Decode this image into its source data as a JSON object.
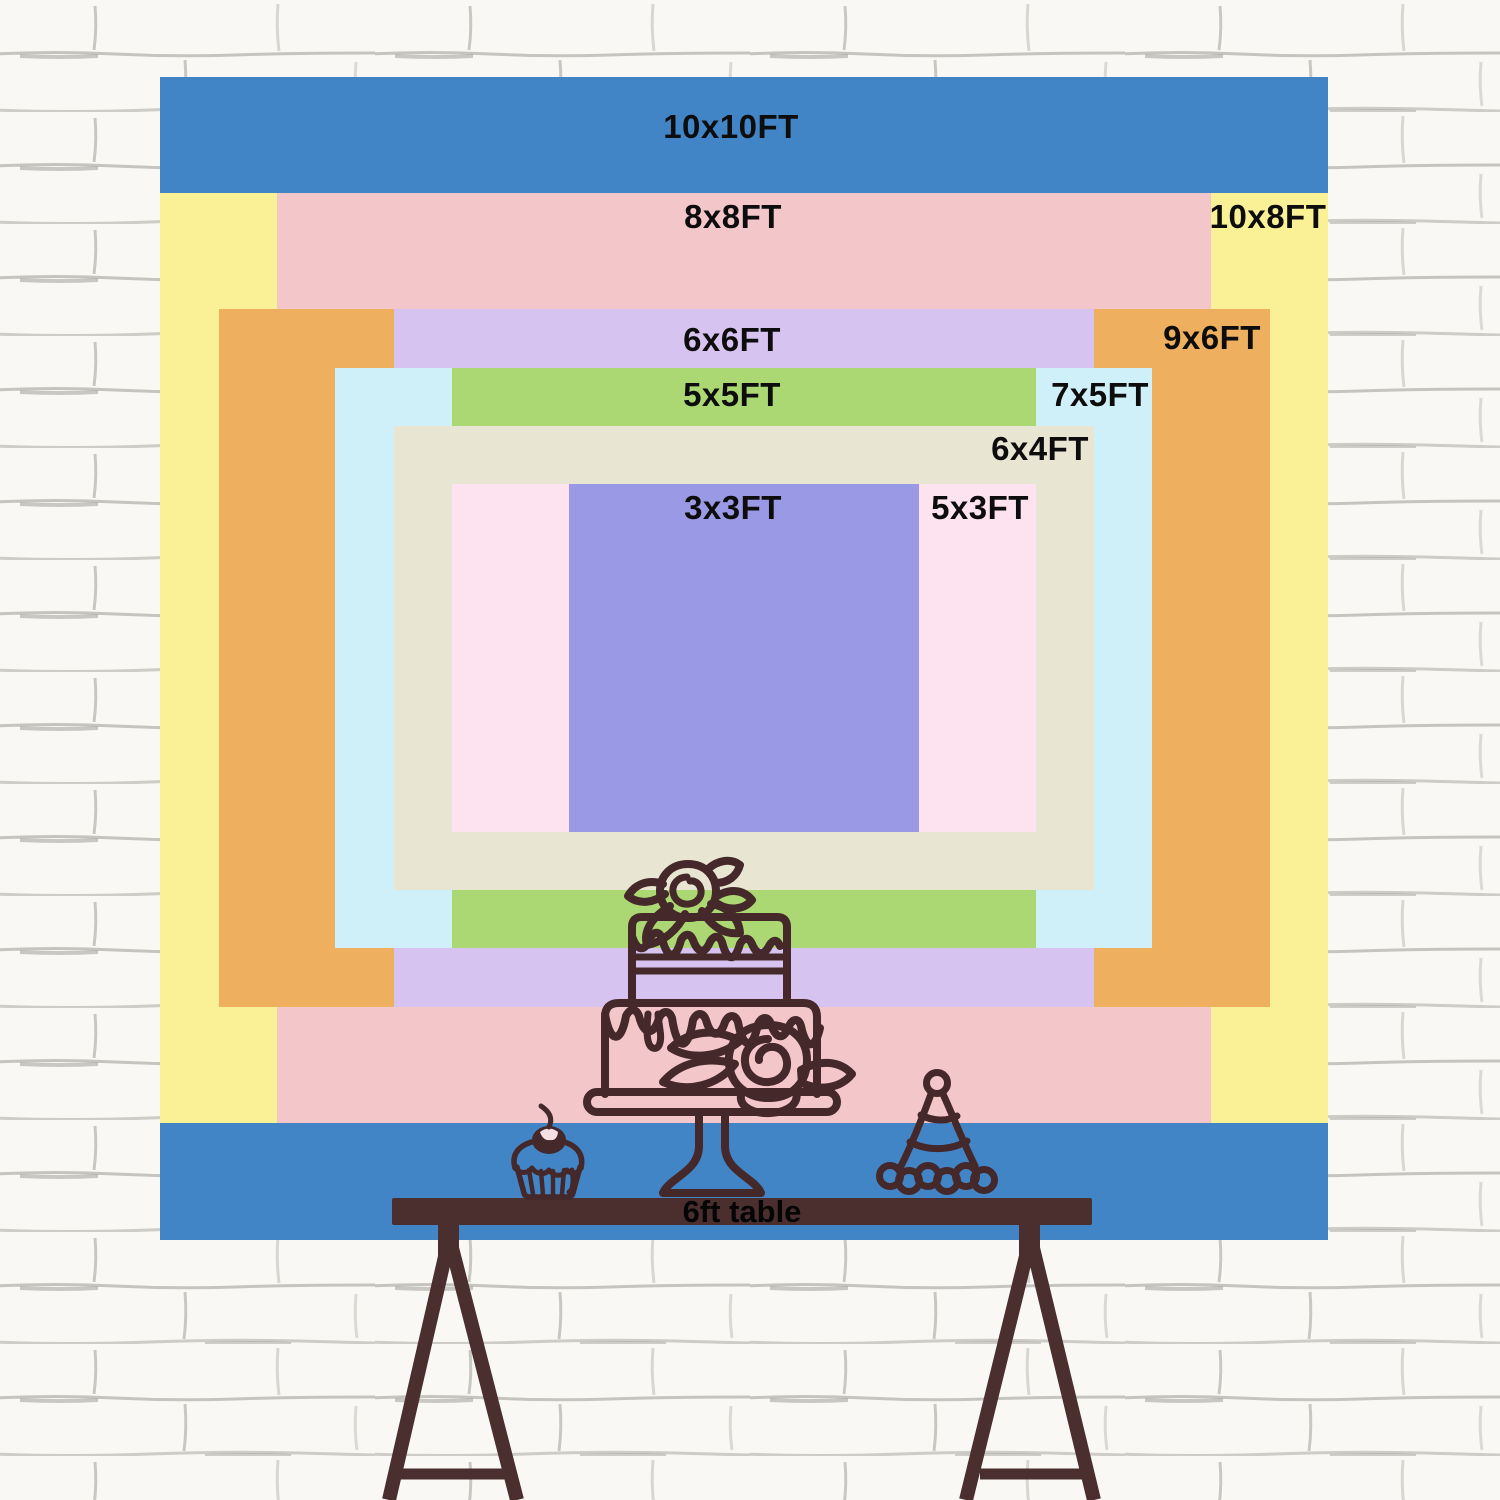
{
  "backdrop": {
    "unit": "FT",
    "label_color": "#0D0D0D",
    "sizes": [
      {
        "label": "10x10FT",
        "width_ft": 10,
        "height_ft": 10,
        "color": "#4285C7",
        "rect": {
          "x": 160,
          "y": 77,
          "w": 1168,
          "h": 1163
        },
        "label_pos": {
          "x": 731,
          "y": 127
        }
      },
      {
        "label": "10x8FT",
        "width_ft": 10,
        "height_ft": 8,
        "color": "#FAF096",
        "rect": {
          "x": 160,
          "y": 193,
          "w": 1168,
          "h": 930
        },
        "label_pos": {
          "x": 1268,
          "y": 217
        }
      },
      {
        "label": "8x8FT",
        "width_ft": 8,
        "height_ft": 8,
        "color": "#F3C6CA",
        "rect": {
          "x": 277,
          "y": 193,
          "w": 934,
          "h": 930
        },
        "label_pos": {
          "x": 733,
          "y": 217
        }
      },
      {
        "label": "9x6FT",
        "width_ft": 9,
        "height_ft": 6,
        "color": "#EEB05F",
        "rect": {
          "x": 219,
          "y": 309,
          "w": 1051,
          "h": 698
        },
        "label_pos": {
          "x": 1212,
          "y": 338
        }
      },
      {
        "label": "6x6FT",
        "width_ft": 6,
        "height_ft": 6,
        "color": "#D7C3F0",
        "rect": {
          "x": 394,
          "y": 309,
          "w": 700,
          "h": 698
        },
        "label_pos": {
          "x": 732,
          "y": 340
        }
      },
      {
        "label": "7x5FT",
        "width_ft": 7,
        "height_ft": 5,
        "color": "#CFEFF9",
        "rect": {
          "x": 335,
          "y": 368,
          "w": 817,
          "h": 580
        },
        "label_pos": {
          "x": 1100,
          "y": 395
        }
      },
      {
        "label": "5x5FT",
        "width_ft": 5,
        "height_ft": 5,
        "color": "#ACD873",
        "rect": {
          "x": 452,
          "y": 368,
          "w": 584,
          "h": 580
        },
        "label_pos": {
          "x": 732,
          "y": 395
        }
      },
      {
        "label": "6x4FT",
        "width_ft": 6,
        "height_ft": 4,
        "color": "#E9E5D3",
        "rect": {
          "x": 394,
          "y": 426,
          "w": 700,
          "h": 464
        },
        "label_pos": {
          "x": 1040,
          "y": 449
        }
      },
      {
        "label": "5x3FT",
        "width_ft": 5,
        "height_ft": 3,
        "color": "#FDE2EF",
        "rect": {
          "x": 452,
          "y": 484,
          "w": 584,
          "h": 348
        },
        "label_pos": {
          "x": 980,
          "y": 508
        }
      },
      {
        "label": "3x3FT",
        "width_ft": 3,
        "height_ft": 3,
        "color": "#9A99E5",
        "rect": {
          "x": 569,
          "y": 484,
          "w": 350,
          "h": 348
        },
        "label_pos": {
          "x": 733,
          "y": 508
        }
      }
    ]
  },
  "table": {
    "label": "6ft table",
    "color": "#4A2F2E",
    "label_color": "#050505",
    "label_pos": {
      "x": 742,
      "y": 1212
    }
  },
  "illustrations": {
    "line_color": "#44282A",
    "items": [
      "birthday-cake-icon",
      "cupcake-icon",
      "party-hat-icon",
      "trestle-table-icon"
    ]
  },
  "wall": {
    "background": "#F9F8F5",
    "mortar_color": "#B5B2AC"
  }
}
